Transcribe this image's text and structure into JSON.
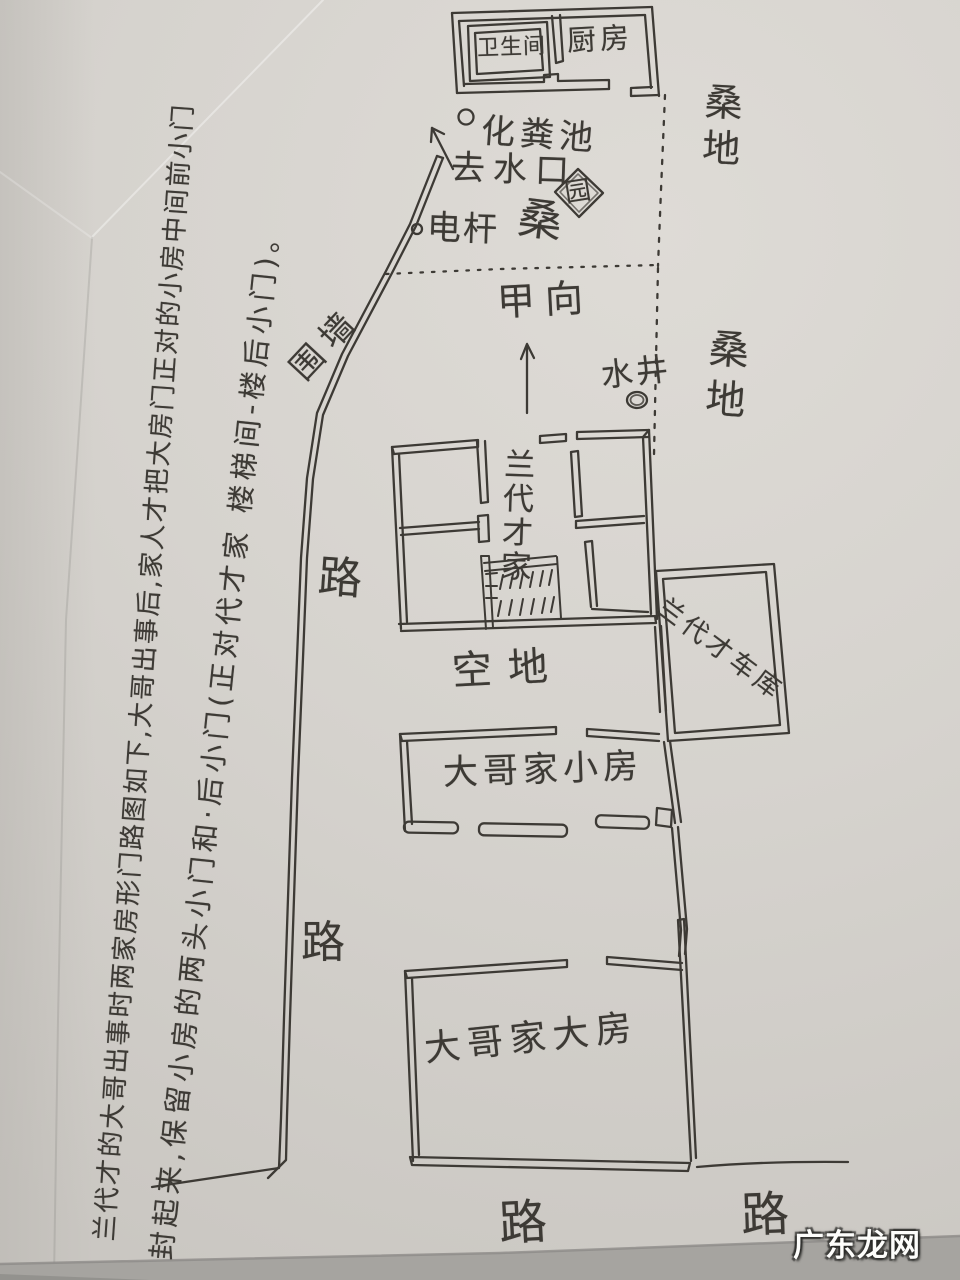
{
  "colors": {
    "ink": "#3d3a35",
    "paper": "#d6d3ce",
    "paper_edge": "#a6a4a0"
  },
  "margin_note": {
    "line1": "兰代才的大哥出事时两家房形门路图如下,大哥出事后,家人才把大房门正对的小房中间前小门",
    "line2": "封起来,保留小房的两头小门和·后小门(正对代才家 楼梯间-楼后小门)。"
  },
  "top_building": {
    "bathroom": "卫生间",
    "kitchen": "厨房"
  },
  "annotations": {
    "septic_tank": "化粪池",
    "drain_outlet": "去水口",
    "power_pole": "电杆",
    "mulberry_scribble": "桑",
    "garden": "园",
    "facing_direction": "甲向",
    "water_well": "水井",
    "enclosing_wall": "围墙",
    "open_ground": "空地"
  },
  "fields": {
    "mulberry_top": "桑地",
    "mulberry_right": "桑地"
  },
  "buildings": {
    "main_house": "兰代才家",
    "garage": "兰代才车库",
    "small_house": "大哥家小房",
    "big_house": "大哥家大房"
  },
  "roads": {
    "left_upper": "路",
    "left_lower": "路",
    "bottom_center": "路",
    "bottom_right": "路"
  },
  "watermark": "广东龙网"
}
